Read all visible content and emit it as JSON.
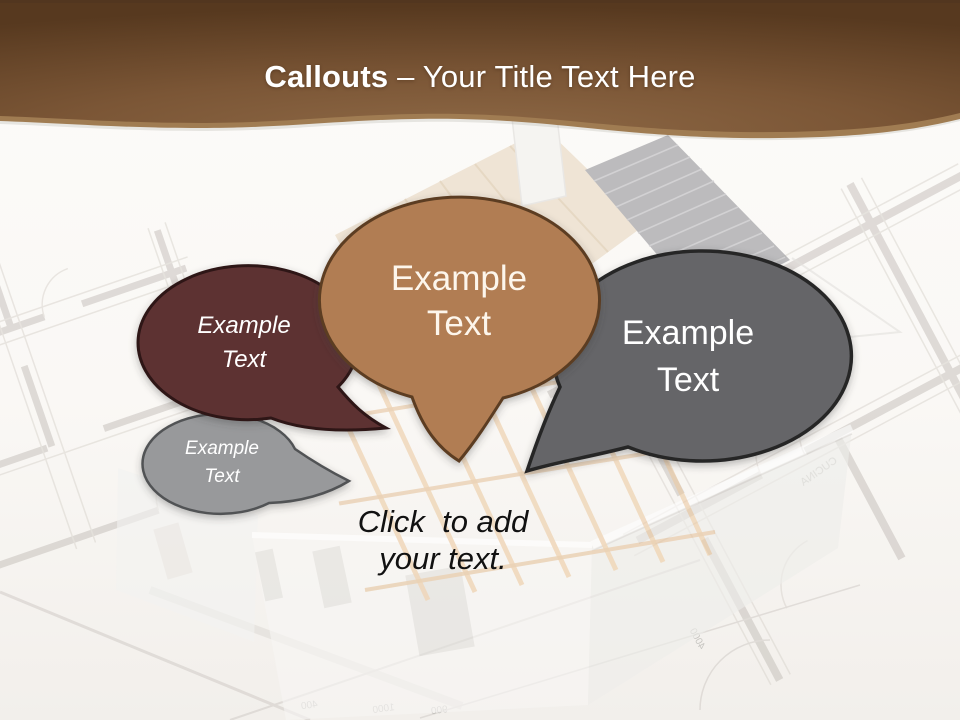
{
  "slide": {
    "title": {
      "emphasis": "Callouts",
      "rest": " – Your Title Text Here"
    }
  },
  "theme": {
    "banner_light": "#8d6845",
    "banner_mid": "#7b5636",
    "banner_dark": "#57391f",
    "banner_edge_highlight": "#a07c52",
    "title_color": "#ffffff",
    "placeholder_color": "#111111",
    "page_background": "#fbfaf8"
  },
  "callouts": [
    {
      "id": "gray-small",
      "lines": [
        "Example",
        "Text"
      ],
      "fill": "#98999b",
      "stroke": "#515254",
      "text_color": "#ffffff",
      "italic": true
    },
    {
      "id": "maroon",
      "lines": [
        "Example",
        "Text"
      ],
      "fill": "#5d3132",
      "stroke": "#2e1718",
      "text_color": "#ffffff",
      "italic": true
    },
    {
      "id": "gray-large",
      "lines": [
        "Example",
        "Text"
      ],
      "fill": "#656567",
      "stroke": "#262626",
      "text_color": "#ffffff",
      "italic": false
    },
    {
      "id": "tan",
      "lines": [
        "Example",
        "Text"
      ],
      "fill": "#b17d52",
      "stroke": "#5c3d22",
      "text_color": "#fdf6ec",
      "italic": false
    }
  ],
  "placeholder": {
    "lines": [
      "Click  to add",
      "your text."
    ]
  },
  "background": {
    "blueprint_labels": [
      "400",
      "1000",
      "900",
      "4000",
      "CUCINA"
    ]
  }
}
